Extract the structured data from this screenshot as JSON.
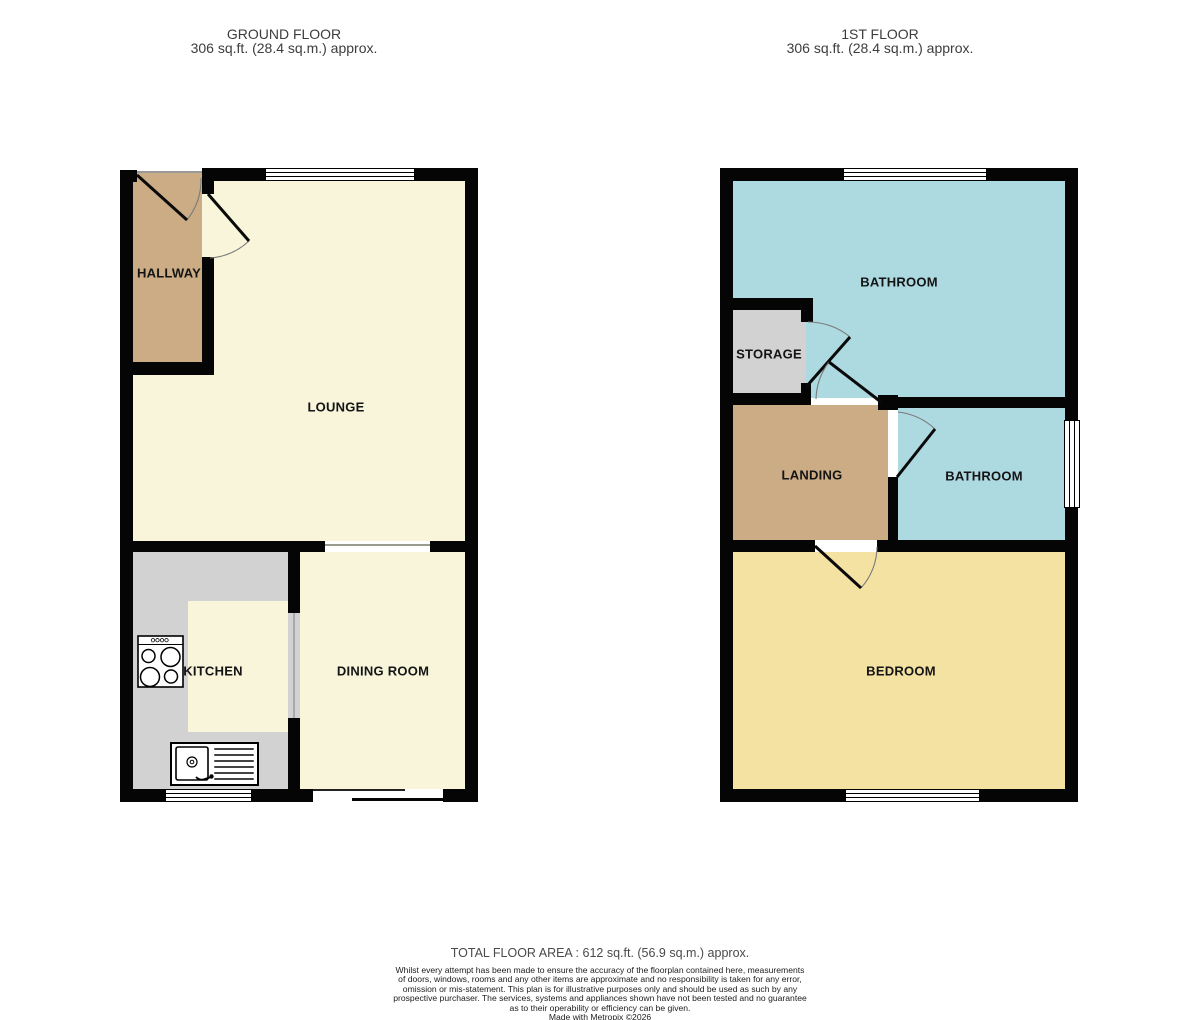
{
  "colors": {
    "cream": "#f8f5db",
    "tan": "#cbac85",
    "gray": "#d2d2d2",
    "blue": "#add9e0",
    "wheat": "#f4e2a3",
    "wall": "#050505"
  },
  "ground_floor": {
    "title": "GROUND FLOOR",
    "area": "306 sq.ft. (28.4 sq.m.) approx.",
    "rooms": {
      "hallway": "HALLWAY",
      "lounge": "LOUNGE",
      "kitchen": "KITCHEN",
      "dining_room": "DINING ROOM"
    }
  },
  "first_floor": {
    "title": "1ST FLOOR",
    "area": "306 sq.ft. (28.4 sq.m.) approx.",
    "rooms": {
      "bathroom_top": "BATHROOM",
      "storage": "STORAGE",
      "landing": "LANDING",
      "bathroom_right": "BATHROOM",
      "bedroom": "BEDROOM"
    }
  },
  "footer": {
    "total_area": "TOTAL FLOOR AREA : 612 sq.ft. (56.9 sq.m.) approx.",
    "disclaimer_lines": [
      "Whilst every attempt has been made to ensure the accuracy of the floorplan contained here, measurements",
      "of doors, windows, rooms and any other items are approximate and no responsibility is taken for any error,",
      "omission or mis-statement. This plan is for illustrative purposes only and should be used as such by any",
      "prospective purchaser. The services, systems and appliances shown have not been tested and no guarantee",
      "as to their operability or efficiency can be given."
    ],
    "credit": "Made with Metropix ©2026"
  }
}
